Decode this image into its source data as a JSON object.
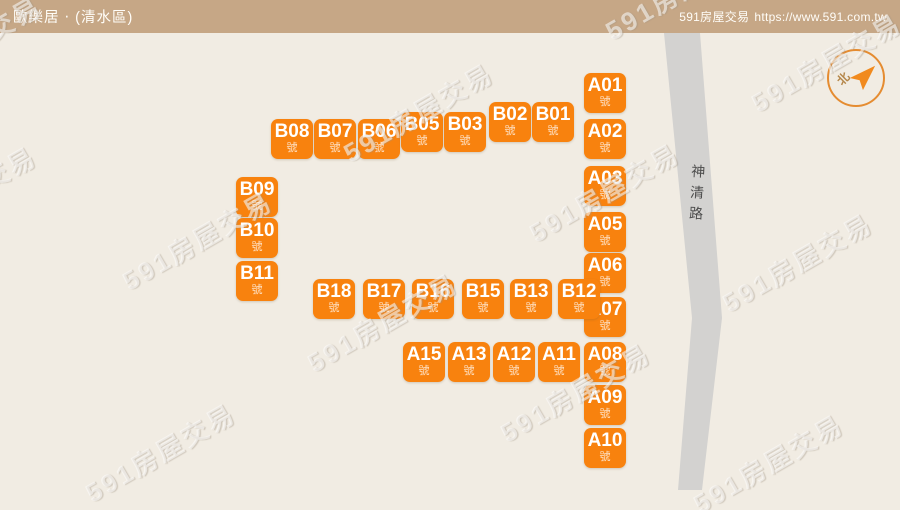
{
  "header": {
    "title": "歐樂居 ‧ (清水區)",
    "brand": "591房屋交易",
    "url": "https://www.591.com.tw"
  },
  "map": {
    "watermark_text": "591房屋交易",
    "unit_suffix": "號",
    "road_name": "神清路",
    "compass_label": "北",
    "colors": {
      "header_bg": "#c6a786",
      "canvas_bg": "#f1ece3",
      "lot": "#f8820e",
      "road": "#d3d2d0"
    },
    "lots": [
      {
        "id": "A01",
        "x": 584,
        "y": 73
      },
      {
        "id": "A02",
        "x": 584,
        "y": 119
      },
      {
        "id": "A03",
        "x": 584,
        "y": 166
      },
      {
        "id": "A05",
        "x": 584,
        "y": 212
      },
      {
        "id": "A06",
        "x": 584,
        "y": 253
      },
      {
        "id": "A07",
        "x": 584,
        "y": 297
      },
      {
        "id": "A08",
        "x": 584,
        "y": 342
      },
      {
        "id": "A09",
        "x": 584,
        "y": 385
      },
      {
        "id": "A10",
        "x": 584,
        "y": 428
      },
      {
        "id": "B08",
        "x": 271,
        "y": 119
      },
      {
        "id": "B07",
        "x": 314,
        "y": 119
      },
      {
        "id": "B06",
        "x": 358,
        "y": 119
      },
      {
        "id": "B05",
        "x": 401,
        "y": 112
      },
      {
        "id": "B03",
        "x": 444,
        "y": 112
      },
      {
        "id": "B02",
        "x": 489,
        "y": 102
      },
      {
        "id": "B01",
        "x": 532,
        "y": 102
      },
      {
        "id": "B09",
        "x": 236,
        "y": 177
      },
      {
        "id": "B10",
        "x": 236,
        "y": 218
      },
      {
        "id": "B11",
        "x": 236,
        "y": 261
      },
      {
        "id": "B18",
        "x": 313,
        "y": 279
      },
      {
        "id": "B17",
        "x": 363,
        "y": 279
      },
      {
        "id": "B16",
        "x": 412,
        "y": 279
      },
      {
        "id": "B15",
        "x": 462,
        "y": 279
      },
      {
        "id": "B13",
        "x": 510,
        "y": 279
      },
      {
        "id": "B12",
        "x": 558,
        "y": 279
      },
      {
        "id": "A15",
        "x": 403,
        "y": 342
      },
      {
        "id": "A13",
        "x": 448,
        "y": 342
      },
      {
        "id": "A12",
        "x": 493,
        "y": 342
      },
      {
        "id": "A11",
        "x": 538,
        "y": 342
      }
    ],
    "watermarks": [
      {
        "x": -34,
        "y": 45
      },
      {
        "x": 680,
        "y": -10
      },
      {
        "x": 826,
        "y": 62
      },
      {
        "x": 418,
        "y": 112
      },
      {
        "x": -39,
        "y": 195
      },
      {
        "x": 604,
        "y": 192
      },
      {
        "x": 197,
        "y": 240
      },
      {
        "x": 797,
        "y": 262
      },
      {
        "x": 382,
        "y": 322
      },
      {
        "x": 575,
        "y": 392
      },
      {
        "x": 160,
        "y": 452
      },
      {
        "x": 768,
        "y": 463
      }
    ]
  }
}
